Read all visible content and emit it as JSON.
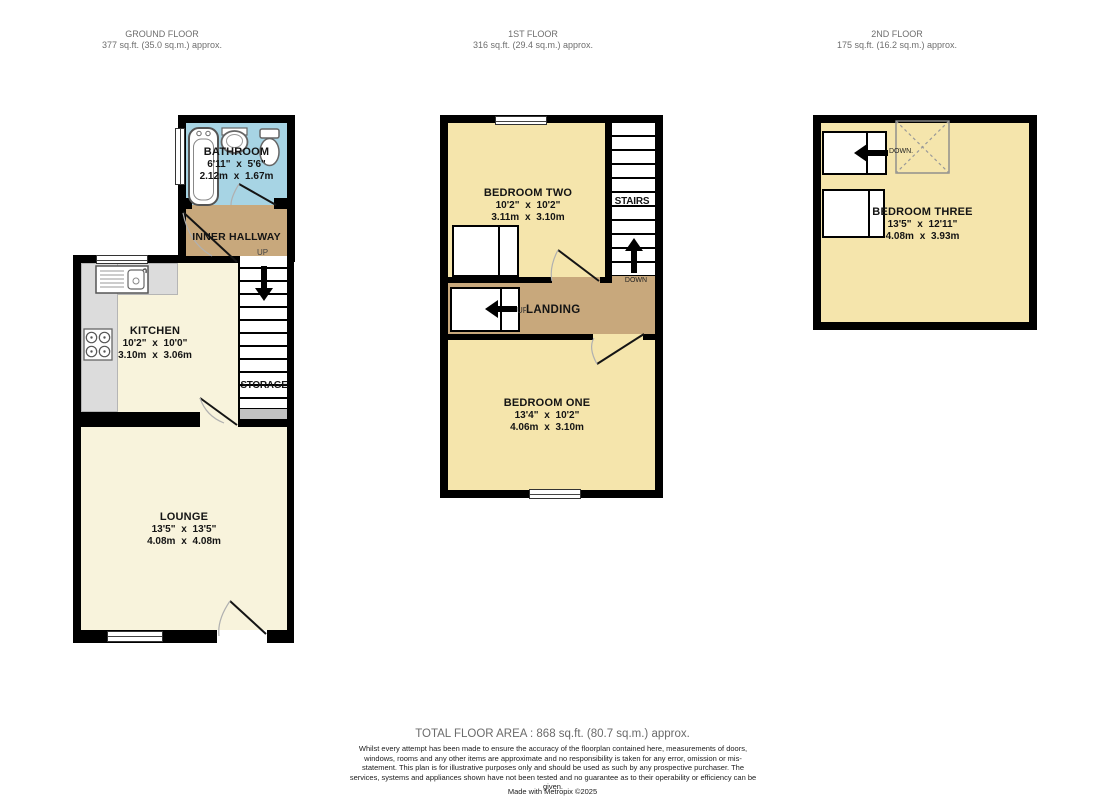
{
  "floors": {
    "ground": {
      "title": "GROUND FLOOR",
      "area_line": "377 sq.ft. (35.0 sq.m.) approx."
    },
    "first": {
      "title": "1ST FLOOR",
      "area_line": "316 sq.ft. (29.4 sq.m.) approx."
    },
    "second": {
      "title": "2ND FLOOR",
      "area_line": "175 sq.ft. (16.2 sq.m.) approx."
    }
  },
  "rooms": {
    "bathroom": {
      "name": "BATHROOM",
      "imperial": "6'11\" x 5'6\"",
      "metric": "2.12m x 1.67m"
    },
    "inner_hallway": {
      "name": "INNER HALLWAY"
    },
    "kitchen": {
      "name": "KITCHEN",
      "imperial": "10'2\" x 10'0\"",
      "metric": "3.10m x 3.06m"
    },
    "lounge": {
      "name": "LOUNGE",
      "imperial": "13'5\" x 13'5\"",
      "metric": "4.08m x 4.08m"
    },
    "bedroom_two": {
      "name": "BEDROOM TWO",
      "imperial": "10'2\" x 10'2\"",
      "metric": "3.11m x 3.10m"
    },
    "bedroom_one": {
      "name": "BEDROOM ONE",
      "imperial": "13'4\" x 10'2\"",
      "metric": "4.06m x 3.10m"
    },
    "bedroom_three": {
      "name": "BEDROOM THREE",
      "imperial": "13'5\" x 12'11\"",
      "metric": "4.08m x 3.93m"
    },
    "landing": {
      "name": "LANDING"
    }
  },
  "labels": {
    "up": "UP",
    "down": "DOWN",
    "down_dot": "DOWN.",
    "stairs": "STAIRS",
    "storage": "STORAGE"
  },
  "footer": {
    "total": "TOTAL FLOOR AREA : 868 sq.ft. (80.7 sq.m.) approx.",
    "disclaimer": "Whilst every attempt has been made to ensure the accuracy of the floorplan contained here, measurements of doors, windows, rooms and any other items are approximate and no responsibility is taken for any error, omission or mis-statement. This plan is for illustrative purposes only and should be used as such by any prospective purchaser. The services, systems and appliances shown have not been tested and no guarantee as to their operability or efficiency can be given.",
    "credit": "Made with Metropix ©2025"
  },
  "colors": {
    "wall": "#000000",
    "bathroom": "#a7d4e4",
    "hallway": "#c8a87c",
    "cream": "#f8f3dc",
    "bedroom": "#f5e5ac",
    "counter": "#dcdcdc",
    "stairgray": "#c2c2c2"
  }
}
